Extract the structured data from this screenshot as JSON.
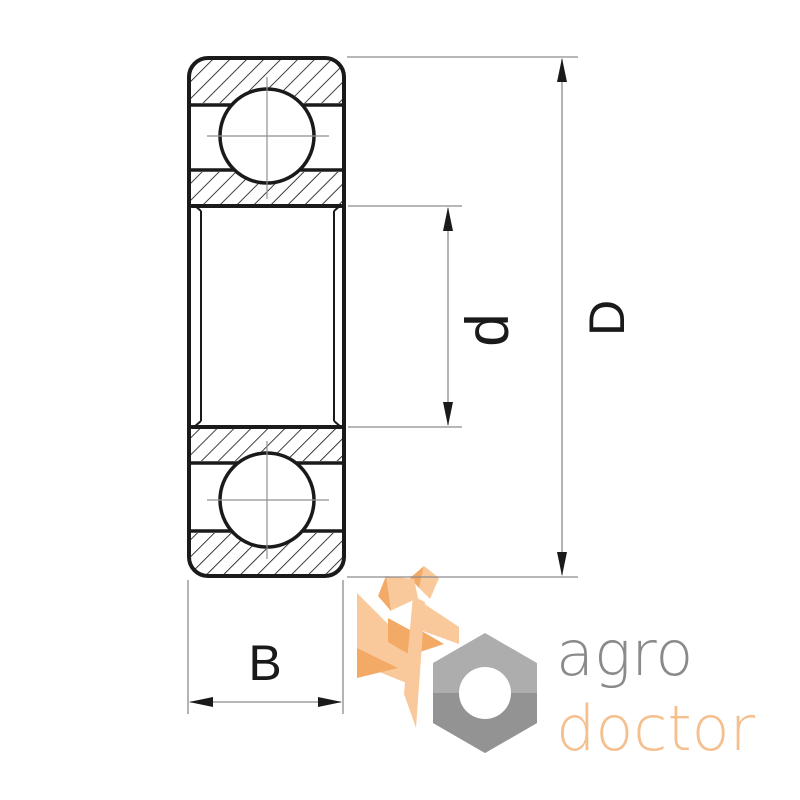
{
  "page": {
    "width": 800,
    "height": 800,
    "background": "#ffffff"
  },
  "drawing": {
    "title": "deep-groove-ball-bearing-cross-section",
    "labels": {
      "outer_diameter": "D",
      "bore_diameter": "d",
      "width": "B"
    },
    "colors": {
      "outline": "#1a1a1a",
      "centerline": "#909090",
      "dimension_line": "#8c8c8c"
    }
  },
  "logo": {
    "text_line1": "agro",
    "text_line2": "doctor",
    "colors": {
      "text_gray": "#8a8a8a",
      "text_orange": "#f6bf8e",
      "wheat_light": "#f9c89b",
      "wheat_dark": "#f3aa66",
      "nut_light": "#adadad",
      "nut_dark": "#939393",
      "nut_hole": "#ffffff"
    }
  }
}
